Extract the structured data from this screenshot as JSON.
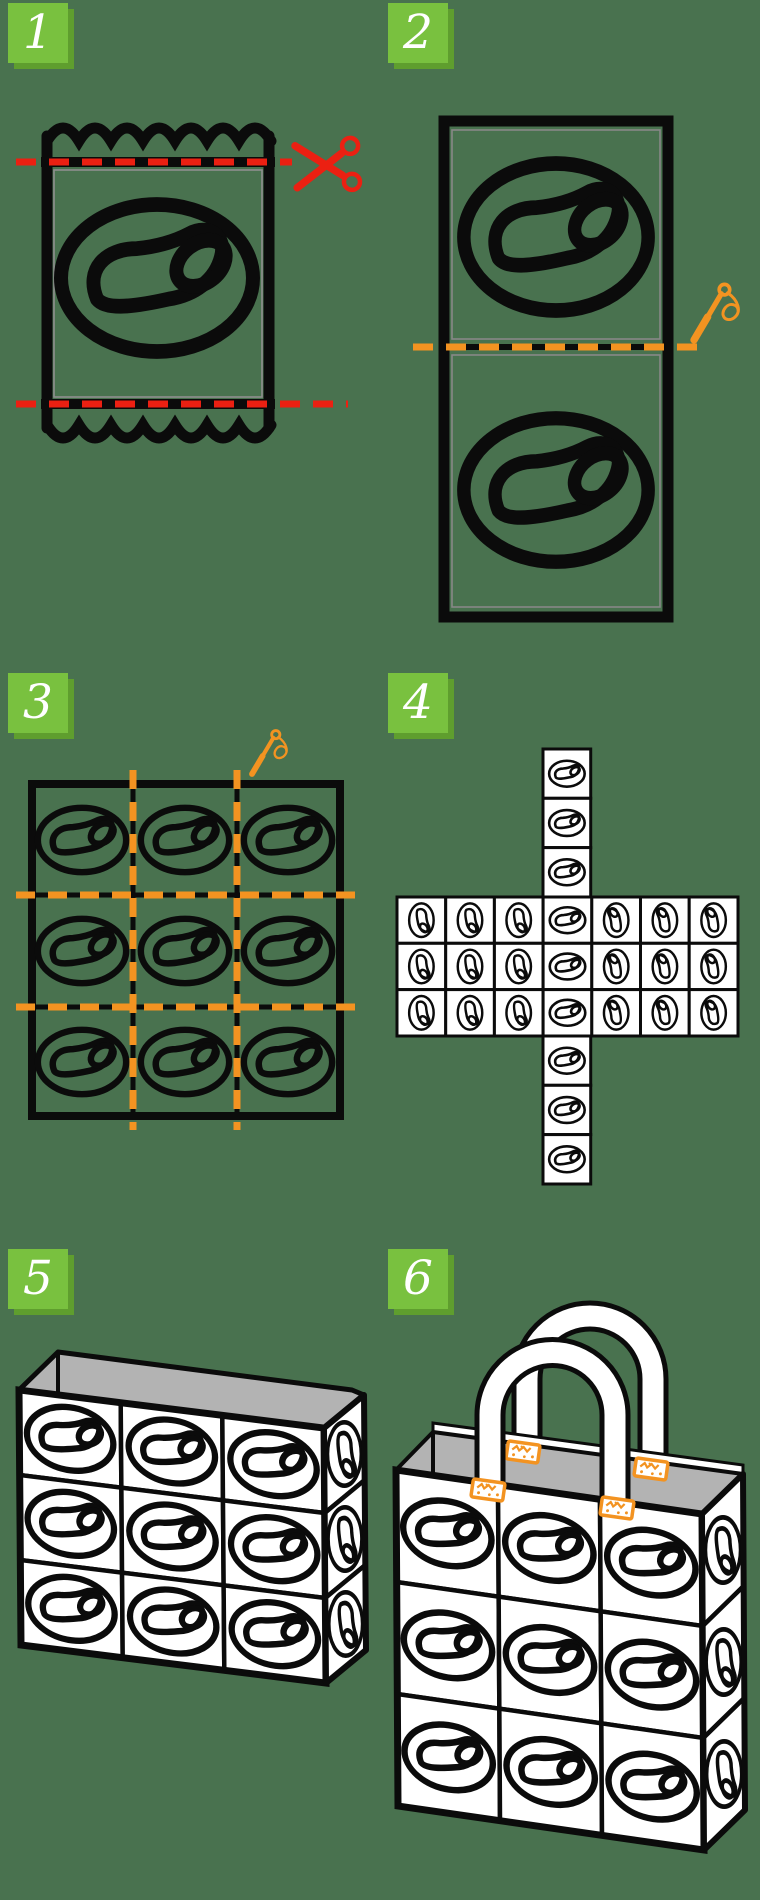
{
  "page": {
    "width": 760,
    "height": 1900,
    "background_color": "#49724F",
    "content": "six-step craft instructions: sewing snack packets into a tote bag"
  },
  "palette": {
    "outline_black": "#0B0B0B",
    "badge_green": "#79C13F",
    "badge_shadow_green": "#5F9E2E",
    "badge_text": "#FFFFFF",
    "cut_line_red": "#EB2012",
    "sew_line_orange": "#F39321",
    "tile_white": "#FFFFFF",
    "bag_interior_gray": "#B3B3B3",
    "packet_inner_border_gray": "#8F8F8F"
  },
  "logo": {
    "name": "pretzel-oval-logo"
  },
  "steps": [
    {
      "number": "1",
      "figure": "snack-packet-with-crimped-ends",
      "icon": "scissors-icon",
      "accent": "#EB2012",
      "cut_lines": 2
    },
    {
      "number": "2",
      "figure": "two-packet-panels-joined",
      "icon": "needle-icon",
      "accent": "#F39321",
      "seam_lines": 1
    },
    {
      "number": "3",
      "figure": "three-by-three-sewn-panel-grid",
      "icon": "needle-icon",
      "accent": "#F39321",
      "grid": {
        "rows": 3,
        "cols": 3
      }
    },
    {
      "number": "4",
      "figure": "box-net-cross-layout",
      "band": {
        "rows": 3,
        "cols": 7
      },
      "top_strip_tiles": 3,
      "bottom_strip_tiles": 3
    },
    {
      "number": "5",
      "figure": "assembled-open-box",
      "front_grid": {
        "rows": 3,
        "cols": 3
      },
      "side_tiles": 3
    },
    {
      "number": "6",
      "figure": "finished-tote-bag",
      "front_grid": {
        "rows": 3,
        "cols": 3
      },
      "side_tiles": 3,
      "handles": 2,
      "stitch_tabs": 4
    }
  ]
}
